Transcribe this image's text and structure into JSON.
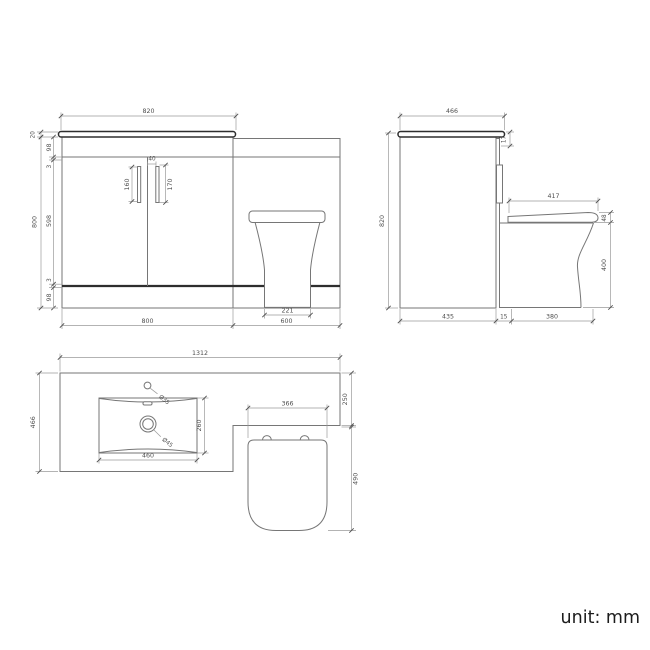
{
  "footer": {
    "unit_label": "unit: mm"
  },
  "front_view": {
    "dims": {
      "counter_width": "820",
      "counter_thickness": "20",
      "top_rail": "98",
      "gap_top": "3",
      "door_height": "598",
      "gap_bottom": "3",
      "plinth": "98",
      "total_height": "800",
      "handle_offset": "40",
      "handle_left_len": "160",
      "handle_right_len": "170",
      "toilet_base": "221",
      "vanity_width": "800",
      "wc_width": "600"
    }
  },
  "side_view": {
    "dims": {
      "depth": "466",
      "counter_edge": "17",
      "total_height": "820",
      "seat_length": "417",
      "seat_rim": "48",
      "bowl_height": "400",
      "cabinet_depth": "435",
      "gap": "15",
      "pan_depth": "380"
    }
  },
  "plan_view": {
    "dims": {
      "total_width": "1312",
      "counter_depth": "466",
      "wc_top_depth": "250",
      "basin_width": "460",
      "basin_depth": "260",
      "tap_hole": "Ø35",
      "waste_hole": "Ø45",
      "seat_width": "366",
      "pan_length": "490"
    }
  }
}
